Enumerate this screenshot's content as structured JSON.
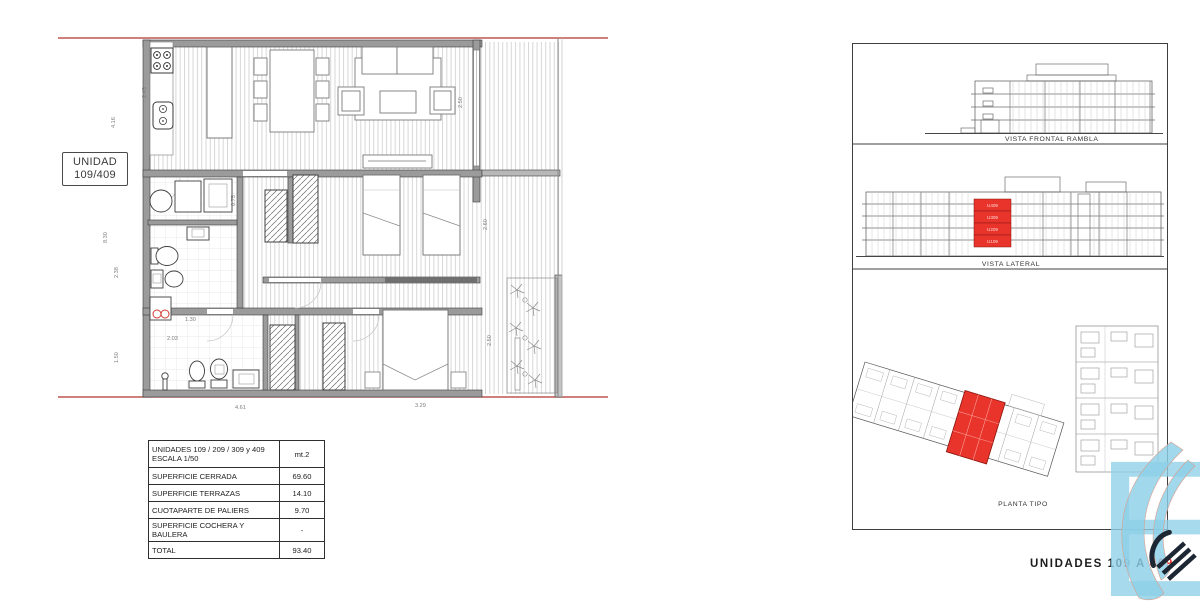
{
  "unit_box": {
    "line1": "UNIDAD",
    "line2": "109/409"
  },
  "table": {
    "header": {
      "title_line1": "UNIDADES 109 / 209 / 309 y 409",
      "title_line2": "ESCALA 1/50",
      "unit": "mt.2"
    },
    "rows": [
      {
        "label": "SUPERFICIE  CERRADA",
        "value": "69.60"
      },
      {
        "label": "SUPERFICIE  TERRAZAS",
        "value": "14.10"
      },
      {
        "label": "CUOTAPARTE DE PALIERS",
        "value": "9.70"
      },
      {
        "label": "SUPERFICIE COCHERA Y BAULERA",
        "value": "-"
      },
      {
        "label": "TOTAL",
        "value": "93.40"
      }
    ]
  },
  "views": {
    "frontal_label": "VISTA FRONTAL RAMBLA",
    "lateral_label": "VISTA LATERAL",
    "planta_label": "PLANTA TIPO",
    "highlighted_units": [
      "U409",
      "U309",
      "U209",
      "U109"
    ]
  },
  "dims": {
    "left": [
      "4.16",
      "8.30",
      "2.38",
      "1.50"
    ],
    "kitchen": "2.45",
    "bottom": [
      "4.61",
      "3.29"
    ],
    "right": [
      "2.50",
      "2.60",
      "2.50"
    ],
    "bath": [
      "1.30",
      "2.03",
      "0.75"
    ]
  },
  "footer": {
    "text": "UNIDADES 109 A",
    "accent": "409"
  },
  "colors": {
    "accent_red": "#e8342a",
    "logo_blue": "#8ecfe8"
  }
}
